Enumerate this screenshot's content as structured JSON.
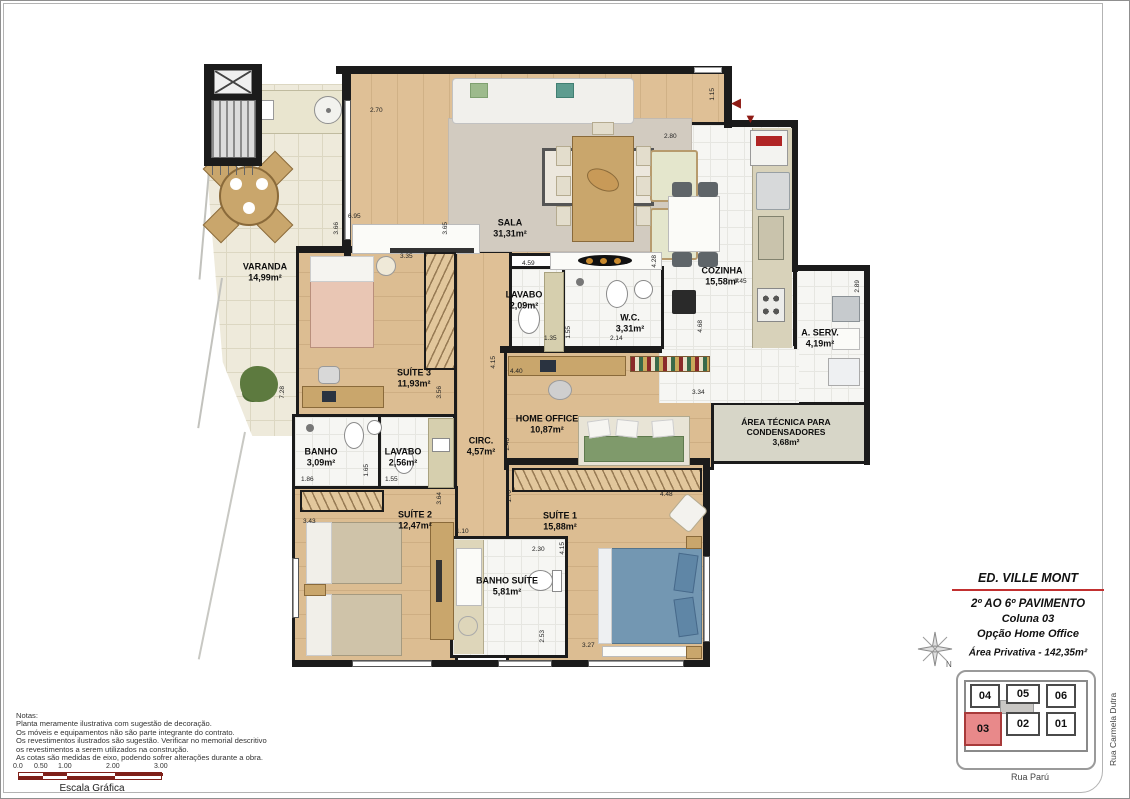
{
  "title_block": {
    "building": "ED. VILLE MONT",
    "line1": "2º AO 6º PAVIMENTO",
    "line2": "Coluna 03",
    "line3": "Opção Home Office",
    "area": "Área Privativa - 142,35m²"
  },
  "compass": {
    "label": "N"
  },
  "key_plan": {
    "units": [
      {
        "label": "04",
        "highlighted": false
      },
      {
        "label": "05",
        "highlighted": false
      },
      {
        "label": "06",
        "highlighted": false
      },
      {
        "label": "03",
        "highlighted": true
      },
      {
        "label": "02",
        "highlighted": false
      },
      {
        "label": "01",
        "highlighted": false
      }
    ],
    "streets": {
      "bottom": "Rua Parú",
      "right": "Rua Carmela Dutra"
    },
    "highlight_color": "#e8898a"
  },
  "notes": {
    "lines": [
      "Notas:",
      "Planta meramente ilustrativa com sugestão de decoração.",
      "Os móveis e equipamentos não são parte integrante do contrato.",
      "Os revestimentos ilustrados são sugestão. Verificar no memorial descritivo",
      "os revestimentos a serem utilizados na construção.",
      "As cotas são medidas de eixo, podendo sofrer alterações durante a obra."
    ]
  },
  "scale": {
    "ticks": [
      "0.0",
      "0.50",
      "1.00",
      "2.00",
      "3.00"
    ],
    "label": "Escala Gráfica"
  },
  "rooms": [
    {
      "name": "VARANDA",
      "area": "14,99m²"
    },
    {
      "name": "SALA",
      "area": "31,31m²"
    },
    {
      "name": "COZINHA",
      "area": "15,58m²"
    },
    {
      "name": "LAVABO",
      "area": "2,09m²"
    },
    {
      "name": "W.C.",
      "area": "3,31m²"
    },
    {
      "name": "A. SERV.",
      "area": "4,19m²"
    },
    {
      "name": "ÁREA TÉCNICA PARA CONDENSADORES",
      "area": "3,68m²"
    },
    {
      "name": "SUÍTE 3",
      "area": "11,93m²"
    },
    {
      "name": "HOME OFFICE",
      "area": "10,87m²"
    },
    {
      "name": "CIRC.",
      "area": "4,57m²"
    },
    {
      "name": "BANHO",
      "area": "3,09m²"
    },
    {
      "name": "LAVABO",
      "area": "2,56m²"
    },
    {
      "name": "SUÍTE 2",
      "area": "12,47m²"
    },
    {
      "name": "SUÍTE 1",
      "area": "15,88m²"
    },
    {
      "name": "BANHO SUÍTE",
      "area": "5,81m²"
    }
  ],
  "dims": [
    "2.70",
    "1.15",
    "2.80",
    "6.95",
    "3.66",
    "3.65",
    "3.35",
    "4.59",
    "4.28",
    "1.45",
    "2.89",
    "1.35",
    "1.55",
    "2.14",
    "4.68",
    "3.34",
    "7.28",
    "3.56",
    "4.15",
    "4.40",
    "2.46",
    "1.86",
    "1.65",
    "1.55",
    "3.43",
    "3.64",
    "1.70",
    "4.48",
    "1.10",
    "2.30",
    "4.15",
    "2.53",
    "3.27"
  ],
  "entry": {
    "arrows": [
      "◀",
      "▼"
    ]
  },
  "colors": {
    "wall": "#1b1b1b",
    "wood_floor": "#dfc096",
    "tile_floor": "#f6f6f3",
    "varanda_floor": "#eeeadb",
    "tech_area": "#d7d6c8",
    "unit_highlight": "#e8898a",
    "title_rule": "#c23030",
    "entry_arrow": "#8e1b15",
    "scale_bar": "#7e2019"
  }
}
